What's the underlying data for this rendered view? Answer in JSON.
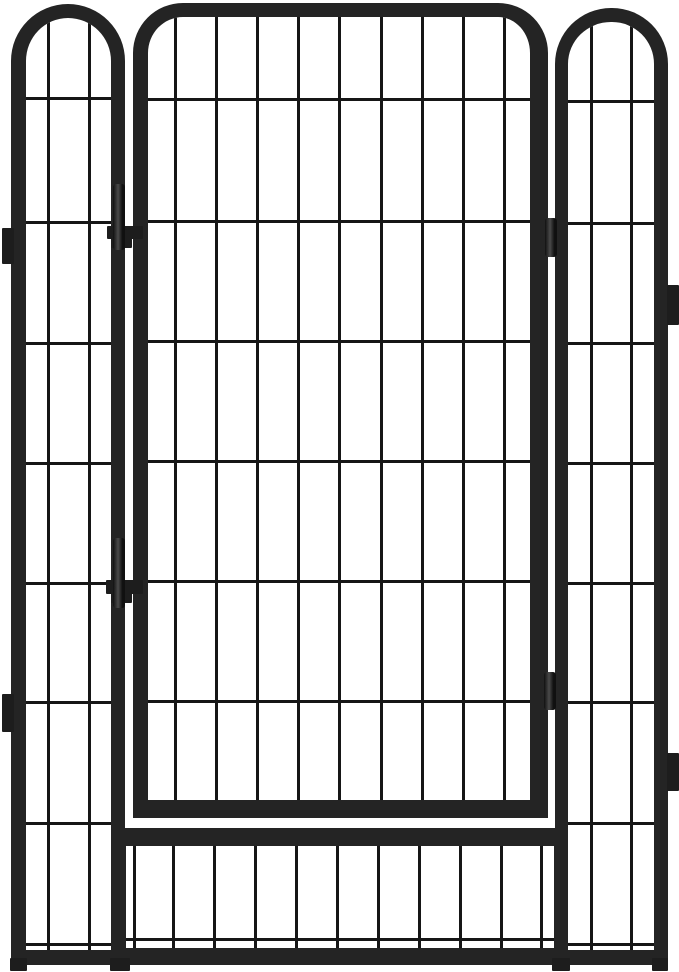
{
  "scene": {
    "subject": "black metal pet playpen panels with arched door",
    "background": "#ffffff",
    "canvas": {
      "width": 679,
      "height": 972
    },
    "colors": {
      "frame": "#242424",
      "wire": "#161616",
      "hardware": "#1d1d1d",
      "pin_gradient_light": "#4a4a4a",
      "pin_gradient_dark": "#101010"
    },
    "wire_thickness": 3
  },
  "panels": [
    {
      "name": "bottom-grid-section",
      "x": 113,
      "y": 828,
      "width": 455,
      "height": 137,
      "frame": {
        "top": 18,
        "right": 14,
        "bottom": 17,
        "left": 13
      },
      "corner_radius": 0,
      "vertical_wires": [
        133,
        172,
        213,
        254,
        295,
        336,
        377,
        418,
        459,
        500,
        540
      ],
      "horizontal_wires": [
        938
      ]
    },
    {
      "name": "left-side-panel",
      "x": 11,
      "y": 4,
      "width": 114,
      "height": 961,
      "frame": {
        "top": 14,
        "right": 14,
        "bottom": 15,
        "left": 15
      },
      "corner_radius": 57,
      "vertical_wires": [
        47,
        88
      ],
      "horizontal_wires": [
        97,
        221,
        342,
        462,
        582,
        701,
        822,
        943
      ]
    },
    {
      "name": "door-panel",
      "x": 133,
      "y": 3,
      "width": 415,
      "height": 815,
      "frame": {
        "top": 14,
        "right": 18,
        "bottom": 18,
        "left": 15
      },
      "corner_radius": 50,
      "vertical_wires": [
        174,
        215,
        256,
        297,
        338,
        380,
        421,
        462,
        503
      ],
      "horizontal_wires": [
        98,
        220,
        340,
        460,
        580,
        700
      ]
    },
    {
      "name": "right-side-panel",
      "x": 555,
      "y": 8,
      "width": 113,
      "height": 957,
      "frame": {
        "top": 14,
        "right": 14,
        "bottom": 15,
        "left": 13
      },
      "corner_radius": 56,
      "vertical_wires": [
        590,
        630
      ],
      "horizontal_wires": [
        100,
        222,
        342,
        462,
        582,
        701,
        822,
        943
      ]
    }
  ],
  "hardware": [
    {
      "name": "foot-left-outer",
      "x": 10,
      "y": 958,
      "width": 17,
      "height": 13,
      "style": "block"
    },
    {
      "name": "foot-left-inner",
      "x": 110,
      "y": 958,
      "width": 20,
      "height": 13,
      "style": "block"
    },
    {
      "name": "foot-right-inner",
      "x": 552,
      "y": 958,
      "width": 18,
      "height": 13,
      "style": "block"
    },
    {
      "name": "foot-right-outer",
      "x": 652,
      "y": 958,
      "width": 16,
      "height": 13,
      "style": "block"
    },
    {
      "name": "hinge-clamp-upper",
      "x": 107,
      "y": 226,
      "width": 36,
      "height": 13,
      "style": "block"
    },
    {
      "name": "hinge-nut-upper",
      "x": 111,
      "y": 238,
      "width": 21,
      "height": 10,
      "style": "block"
    },
    {
      "name": "hinge-pin-upper",
      "x": 113,
      "y": 184,
      "width": 12,
      "height": 66,
      "style": "pin"
    },
    {
      "name": "hinge-clamp-lower",
      "x": 106,
      "y": 580,
      "width": 37,
      "height": 14,
      "style": "block"
    },
    {
      "name": "hinge-nut-lower",
      "x": 111,
      "y": 593,
      "width": 21,
      "height": 10,
      "style": "block"
    },
    {
      "name": "hinge-pin-lower",
      "x": 113,
      "y": 538,
      "width": 12,
      "height": 70,
      "style": "pin"
    },
    {
      "name": "connector-right-upper",
      "x": 545,
      "y": 218,
      "width": 12,
      "height": 39,
      "style": "pin"
    },
    {
      "name": "connector-right-lower",
      "x": 544,
      "y": 672,
      "width": 12,
      "height": 38,
      "style": "pin"
    },
    {
      "name": "mount-tab-left-upper",
      "x": 2,
      "y": 228,
      "width": 12,
      "height": 36,
      "style": "block"
    },
    {
      "name": "mount-tab-left-lower",
      "x": 2,
      "y": 694,
      "width": 12,
      "height": 38,
      "style": "block"
    },
    {
      "name": "mount-tab-right-upper",
      "x": 667,
      "y": 285,
      "width": 12,
      "height": 40,
      "style": "block"
    },
    {
      "name": "mount-tab-right-lower",
      "x": 667,
      "y": 753,
      "width": 12,
      "height": 38,
      "style": "block"
    }
  ]
}
